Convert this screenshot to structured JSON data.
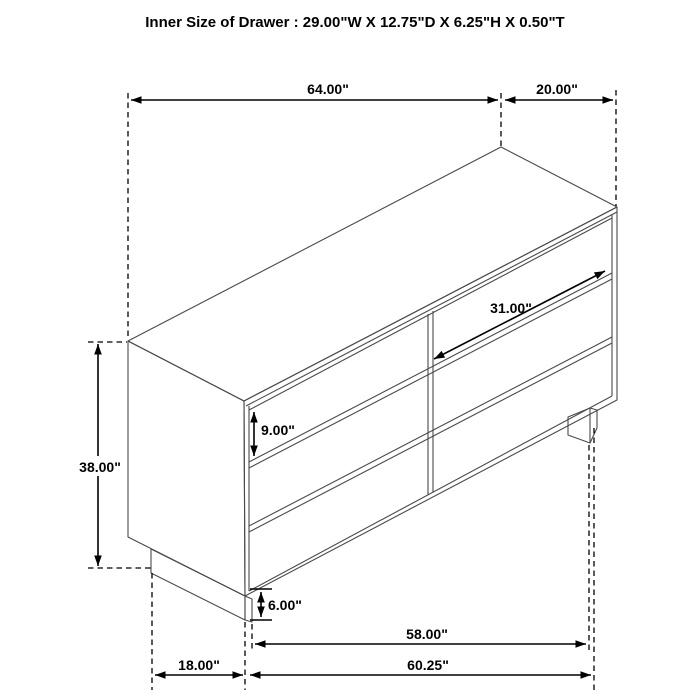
{
  "title": "Inner Size of Drawer : 29.00\"W X 12.75\"D X 6.25\"H X 0.50\"T",
  "dimensions": [
    {
      "id": "overall-width",
      "value": "64.00\""
    },
    {
      "id": "overall-depth",
      "value": "20.00\""
    },
    {
      "id": "overall-height",
      "value": "38.00\""
    },
    {
      "id": "drawer-front-height",
      "value": "9.00\""
    },
    {
      "id": "drawer-front-width",
      "value": "31.00\""
    },
    {
      "id": "base-clearance-height",
      "value": "6.00\""
    },
    {
      "id": "base-side-depth",
      "value": "18.00\""
    },
    {
      "id": "base-front-inner-width",
      "value": "58.00\""
    },
    {
      "id": "base-front-width",
      "value": "60.25\""
    }
  ]
}
